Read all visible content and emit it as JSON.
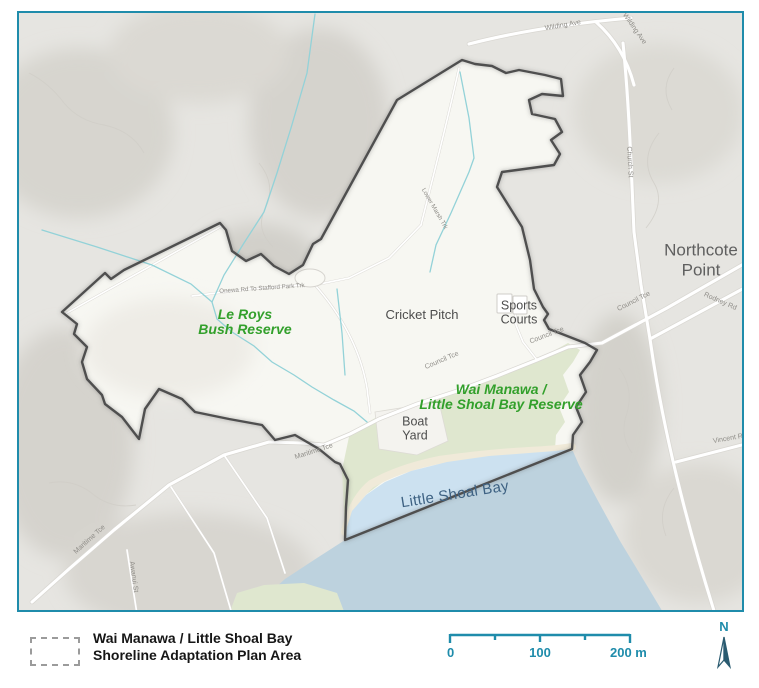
{
  "map": {
    "area_labels": {
      "le_roys": {
        "line1": "Le Roys",
        "line2": "Bush Reserve"
      },
      "wai_manawa": {
        "line1": "Wai Manawa /",
        "line2": "Little Shoal Bay Reserve"
      },
      "cricket_pitch": "Cricket Pitch",
      "sports_courts": {
        "line1": "Sports",
        "line2": "Courts"
      },
      "boat_yard": {
        "line1": "Boat",
        "line2": "Yard"
      },
      "northcote_point": {
        "line1": "Northcote",
        "line2": "Point"
      },
      "little_shoal_bay": "Little Shoal Bay"
    },
    "street_labels": [
      "Wilding Ave",
      "Wilding Ave",
      "Church St",
      "Council Tce",
      "Rodney Rd",
      "Vincent Rd",
      "Council Tce",
      "Council Tce",
      "Maritime Tce",
      "Maritime Tce",
      "Awanui St",
      "Onewa Rd To Stafford Park Trk",
      "Lower Marsh Trk"
    ]
  },
  "legend": {
    "line1": "Wai Manawa / Little Shoal Bay",
    "line2": "Shoreline Adaptation Plan Area"
  },
  "scalebar": {
    "tick0": "0",
    "tick100": "100",
    "tick200": "200 m"
  },
  "north_label": "N",
  "colors": {
    "accent": "#1f8cab",
    "boundary": "#4f4f4f",
    "reserve_label": "#33a02c",
    "reserve_fill": "#dfe7cf",
    "water_inner": "#cce1f0",
    "water_outer": "#bdd2de"
  }
}
